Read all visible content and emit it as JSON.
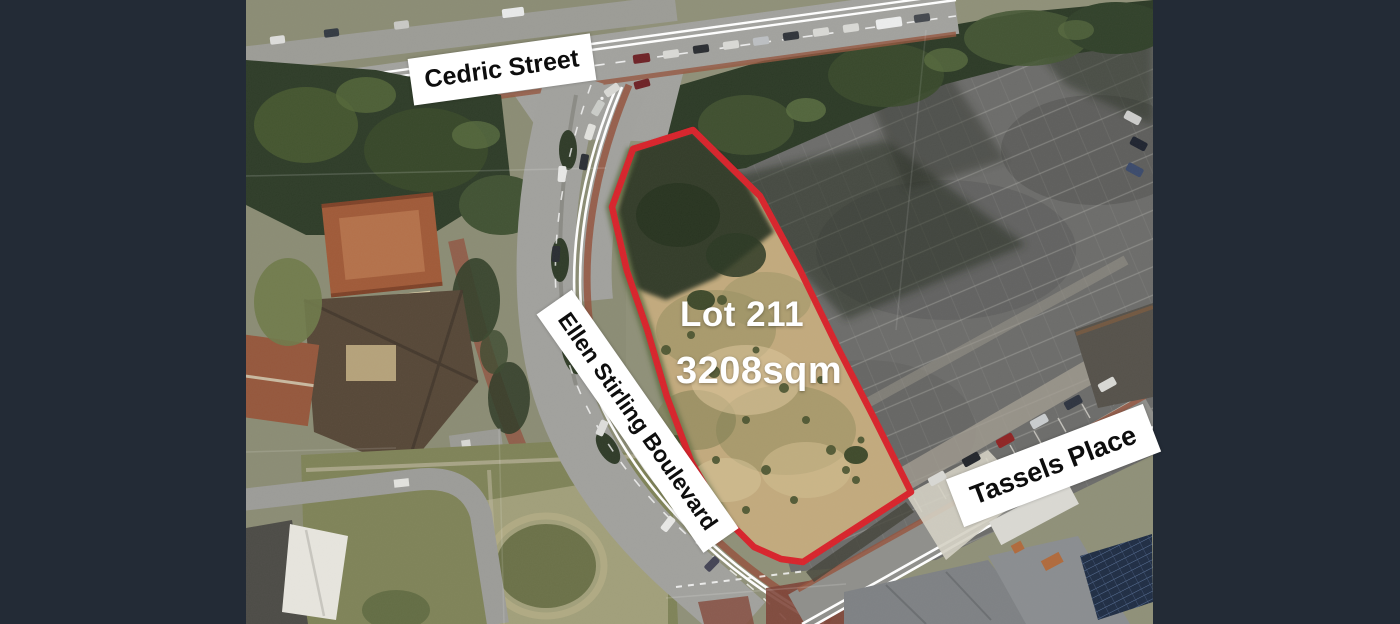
{
  "page": {
    "background": "#232b36",
    "width": 1400,
    "height": 624
  },
  "photo": {
    "left_px": 246,
    "width_px": 907,
    "height_px": 624,
    "kind": "aerial-photograph"
  },
  "street_labels": {
    "cedric": "Cedric Street",
    "ellen_stirling": "Ellen Stirling Boulevard",
    "tassels": "Tassels Place"
  },
  "lot": {
    "name": "Lot 211",
    "area": "3208sqm",
    "boundary_color": "#d8232b",
    "boundary_points": "447,130 514,196 554,270 592,348 628,418 665,492 557,562 535,559 508,547 475,514 445,461 421,397 401,329 381,271 366,207 387,149"
  },
  "palette": {
    "letterbox": "#232b36",
    "road": "#a1a19d",
    "parking_asphalt": "#6c6c6a",
    "lot_sand": "#c2aa7d",
    "trees_dark": "#2e3a27",
    "grass": "#7f8358",
    "brick_path": "#94543e",
    "label_background": "#ffffff",
    "label_text": "#0d0d0d",
    "lot_text": "#ffffff"
  }
}
